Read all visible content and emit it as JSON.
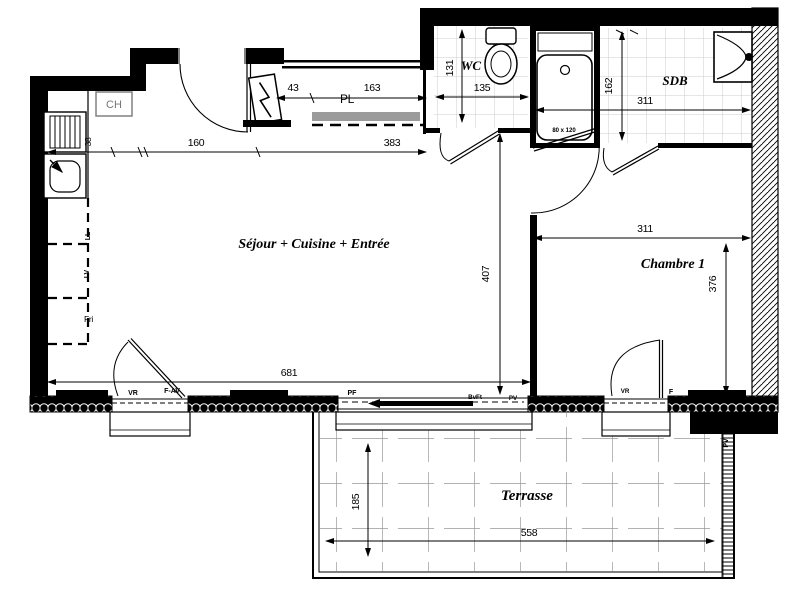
{
  "rooms": {
    "sejour": "Séjour + Cuisine + Entrée",
    "chambre": "Chambre 1",
    "wc": "WC",
    "sdb": "SDB",
    "placard": "PL",
    "terrasse": "Terrasse"
  },
  "dims": {
    "d38": "38",
    "d160": "160",
    "d383": "383",
    "d43": "43",
    "d163": "163",
    "d135": "135",
    "d131": "131",
    "d162": "162",
    "d311_sdb": "311",
    "d311_chambre": "311",
    "d376": "376",
    "d407": "407",
    "d681": "681",
    "d185": "185",
    "d558": "558"
  },
  "fixtures": {
    "water_heater": "CH",
    "fridge": "Fri",
    "washer": "LL",
    "dishwasher": "LV",
    "shower_size": "80 x 120"
  },
  "openings": {
    "w1_shutter": "VR",
    "w1_type": "F-AV",
    "bay_type": "PF",
    "bay_note": "BvFt",
    "bay_screen": "PV",
    "bed_shutter": "VR",
    "bed_window": "F",
    "terrace_screen": "PV"
  },
  "colors": {
    "line": "#000000",
    "tile_line": "#cccccc",
    "terrace_tile_line": "#999999",
    "shelf_gray": "#9b9b9b"
  }
}
